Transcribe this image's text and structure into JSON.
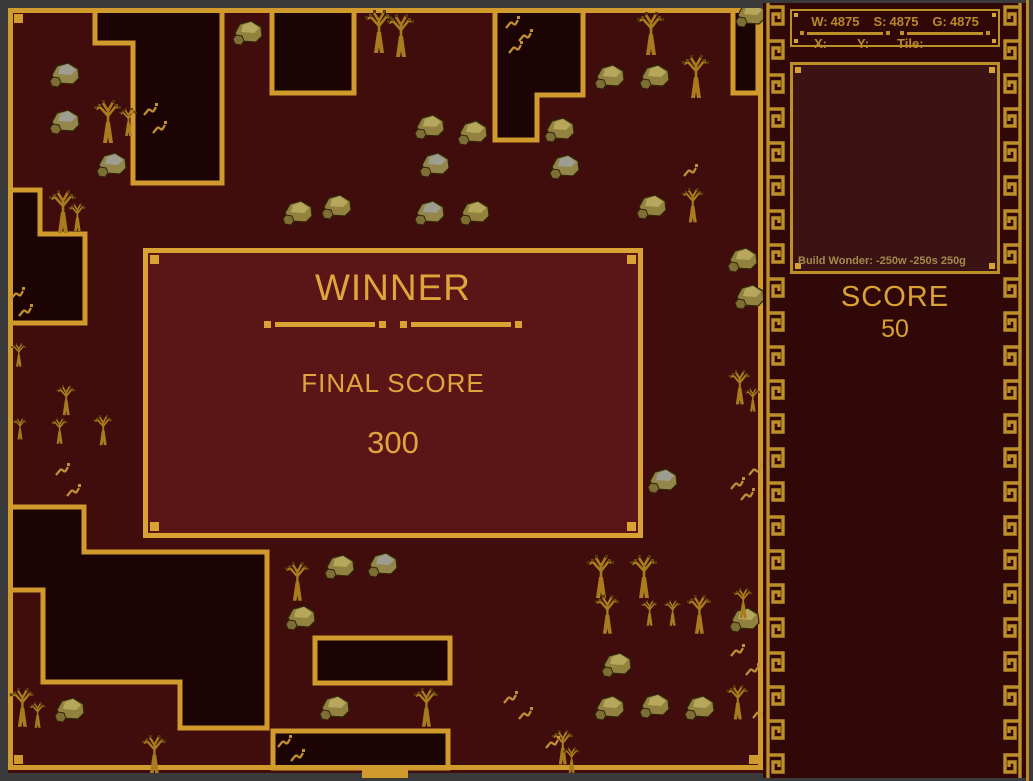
{
  "window": {
    "frame_color": "#3a3a3a"
  },
  "hud": {
    "resources": {
      "wood_label": "W:",
      "wood": "4875",
      "stone_label": "S:",
      "stone": "4875",
      "gold_label": "G:",
      "gold": "4875"
    },
    "cursor": {
      "x_label": "X:",
      "y_label": "Y:",
      "tile_label": "Tile:",
      "x": "",
      "y": "",
      "tile": ""
    },
    "build_hint": "Build Wonder: -250w -250s 250g",
    "score_label": "SCORE",
    "score_value": "50"
  },
  "dialog": {
    "title": "WINNER",
    "subtitle": "FINAL SCORE",
    "value": "300"
  },
  "colors": {
    "map_bg": "#400c0c",
    "region_fill": "#1c0404",
    "gold_line": "#d09a2c",
    "dialog_bg": "#5a1616",
    "dialog_gold": "#dfa53c",
    "sidebar_bg": "#300808",
    "sidebar_gold": "#bd8f28",
    "stats_text": "#b9882c",
    "hint_text": "#a28a4d",
    "score_text": "#d9a233"
  },
  "map": {
    "regions": [
      [
        [
          95,
          10
        ],
        [
          222,
          10
        ],
        [
          222,
          183
        ],
        [
          133,
          183
        ],
        [
          133,
          43
        ],
        [
          95,
          43
        ]
      ],
      [
        [
          272,
          10
        ],
        [
          354,
          10
        ],
        [
          354,
          93
        ],
        [
          272,
          93
        ]
      ],
      [
        [
          495,
          10
        ],
        [
          583,
          10
        ],
        [
          583,
          95
        ],
        [
          537,
          95
        ],
        [
          537,
          140
        ],
        [
          495,
          140
        ]
      ],
      [
        [
          733,
          10
        ],
        [
          758,
          10
        ],
        [
          758,
          93
        ],
        [
          733,
          93
        ]
      ],
      [
        [
          8,
          190
        ],
        [
          40,
          190
        ],
        [
          40,
          234
        ],
        [
          85,
          234
        ],
        [
          85,
          323
        ],
        [
          8,
          323
        ]
      ],
      [
        [
          8,
          507
        ],
        [
          84,
          507
        ],
        [
          84,
          552
        ],
        [
          267,
          552
        ],
        [
          267,
          728
        ],
        [
          180,
          728
        ],
        [
          180,
          682
        ],
        [
          43,
          682
        ],
        [
          43,
          590
        ],
        [
          8,
          590
        ]
      ],
      [
        [
          273,
          731
        ],
        [
          448,
          731
        ],
        [
          448,
          768
        ],
        [
          273,
          768
        ]
      ],
      [
        [
          315,
          638
        ],
        [
          450,
          638
        ],
        [
          450,
          683
        ],
        [
          315,
          683
        ]
      ]
    ],
    "sprites": [
      {
        "type": "rock-gold",
        "x": 233,
        "y": 18
      },
      {
        "type": "rock-gold",
        "x": 736,
        "y": 0
      },
      {
        "type": "rock-gold",
        "x": 595,
        "y": 62
      },
      {
        "type": "rock-gold",
        "x": 640,
        "y": 62
      },
      {
        "type": "rock-gold",
        "x": 415,
        "y": 112
      },
      {
        "type": "rock-gold",
        "x": 458,
        "y": 118
      },
      {
        "type": "rock-gold",
        "x": 545,
        "y": 115
      },
      {
        "type": "rock-gold",
        "x": 460,
        "y": 198
      },
      {
        "type": "rock-gold",
        "x": 283,
        "y": 198
      },
      {
        "type": "rock-gold",
        "x": 322,
        "y": 192
      },
      {
        "type": "rock-gold",
        "x": 637,
        "y": 192
      },
      {
        "type": "rock-gold",
        "x": 728,
        "y": 245
      },
      {
        "type": "rock-gold",
        "x": 735,
        "y": 282
      },
      {
        "type": "rock-gold",
        "x": 325,
        "y": 552
      },
      {
        "type": "rock-gold",
        "x": 286,
        "y": 603
      },
      {
        "type": "rock-gold",
        "x": 55,
        "y": 695
      },
      {
        "type": "rock-gold",
        "x": 320,
        "y": 693
      },
      {
        "type": "rock-gold",
        "x": 602,
        "y": 650
      },
      {
        "type": "rock-gold",
        "x": 595,
        "y": 693
      },
      {
        "type": "rock-gold",
        "x": 640,
        "y": 691
      },
      {
        "type": "rock-gold",
        "x": 685,
        "y": 693
      },
      {
        "type": "rock-gold",
        "x": 730,
        "y": 605
      },
      {
        "type": "rock-gray",
        "x": 50,
        "y": 60
      },
      {
        "type": "rock-gray",
        "x": 50,
        "y": 107
      },
      {
        "type": "rock-gray",
        "x": 97,
        "y": 150
      },
      {
        "type": "rock-gray",
        "x": 420,
        "y": 150
      },
      {
        "type": "rock-gray",
        "x": 550,
        "y": 152
      },
      {
        "type": "rock-gray",
        "x": 415,
        "y": 198
      },
      {
        "type": "rock-gray",
        "x": 368,
        "y": 550
      },
      {
        "type": "rock-gray",
        "x": 648,
        "y": 466
      },
      {
        "type": "tree",
        "x": 363,
        "y": 10,
        "s": 1
      },
      {
        "type": "tree",
        "x": 385,
        "y": 14,
        "s": 1
      },
      {
        "type": "tree",
        "x": 635,
        "y": 12,
        "s": 1
      },
      {
        "type": "tree",
        "x": 680,
        "y": 55,
        "s": 1
      },
      {
        "type": "tree",
        "x": 92,
        "y": 100,
        "s": 1
      },
      {
        "type": "tree",
        "x": 118,
        "y": 108,
        "s": 0.65
      },
      {
        "type": "tree",
        "x": 47,
        "y": 190,
        "s": 1
      },
      {
        "type": "tree",
        "x": 67,
        "y": 203,
        "s": 0.65
      },
      {
        "type": "tree",
        "x": 680,
        "y": 188,
        "s": 0.8
      },
      {
        "type": "tree",
        "x": 727,
        "y": 370,
        "s": 0.8
      },
      {
        "type": "tree",
        "x": 744,
        "y": 388,
        "s": 0.55
      },
      {
        "type": "tree",
        "x": 10,
        "y": 343,
        "s": 0.55
      },
      {
        "type": "tree",
        "x": 55,
        "y": 385,
        "s": 0.7
      },
      {
        "type": "tree",
        "x": 92,
        "y": 415,
        "s": 0.7
      },
      {
        "type": "tree",
        "x": 12,
        "y": 418,
        "s": 0.5
      },
      {
        "type": "tree",
        "x": 50,
        "y": 418,
        "s": 0.6
      },
      {
        "type": "tree",
        "x": 283,
        "y": 562,
        "s": 0.9
      },
      {
        "type": "tree",
        "x": 585,
        "y": 555,
        "s": 1
      },
      {
        "type": "tree",
        "x": 628,
        "y": 555,
        "s": 1
      },
      {
        "type": "tree",
        "x": 593,
        "y": 595,
        "s": 0.9
      },
      {
        "type": "tree",
        "x": 640,
        "y": 600,
        "s": 0.6
      },
      {
        "type": "tree",
        "x": 663,
        "y": 600,
        "s": 0.6
      },
      {
        "type": "tree",
        "x": 685,
        "y": 595,
        "s": 0.9
      },
      {
        "type": "tree",
        "x": 725,
        "y": 685,
        "s": 0.8
      },
      {
        "type": "tree",
        "x": 8,
        "y": 688,
        "s": 0.9
      },
      {
        "type": "tree",
        "x": 28,
        "y": 702,
        "s": 0.6
      },
      {
        "type": "tree",
        "x": 140,
        "y": 735,
        "s": 0.9
      },
      {
        "type": "tree",
        "x": 412,
        "y": 688,
        "s": 0.9
      },
      {
        "type": "tree",
        "x": 550,
        "y": 730,
        "s": 0.8
      },
      {
        "type": "tree",
        "x": 562,
        "y": 747,
        "s": 0.6
      },
      {
        "type": "tree",
        "x": 732,
        "y": 588,
        "s": 0.7
      },
      {
        "type": "grass",
        "x": 505,
        "y": 15
      },
      {
        "type": "grass",
        "x": 518,
        "y": 28
      },
      {
        "type": "grass",
        "x": 508,
        "y": 40
      },
      {
        "type": "grass",
        "x": 143,
        "y": 102
      },
      {
        "type": "grass",
        "x": 152,
        "y": 120
      },
      {
        "type": "grass",
        "x": 10,
        "y": 286
      },
      {
        "type": "grass",
        "x": 18,
        "y": 303
      },
      {
        "type": "grass",
        "x": 55,
        "y": 462
      },
      {
        "type": "grass",
        "x": 66,
        "y": 483
      },
      {
        "type": "grass",
        "x": 748,
        "y": 462
      },
      {
        "type": "grass",
        "x": 730,
        "y": 476
      },
      {
        "type": "grass",
        "x": 740,
        "y": 487
      },
      {
        "type": "grass",
        "x": 730,
        "y": 643
      },
      {
        "type": "grass",
        "x": 745,
        "y": 662
      },
      {
        "type": "grass",
        "x": 503,
        "y": 690
      },
      {
        "type": "grass",
        "x": 518,
        "y": 706
      },
      {
        "type": "grass",
        "x": 545,
        "y": 735
      },
      {
        "type": "grass",
        "x": 752,
        "y": 705
      },
      {
        "type": "grass",
        "x": 683,
        "y": 163
      },
      {
        "type": "grass",
        "x": 277,
        "y": 734
      },
      {
        "type": "grass",
        "x": 290,
        "y": 748
      }
    ]
  }
}
